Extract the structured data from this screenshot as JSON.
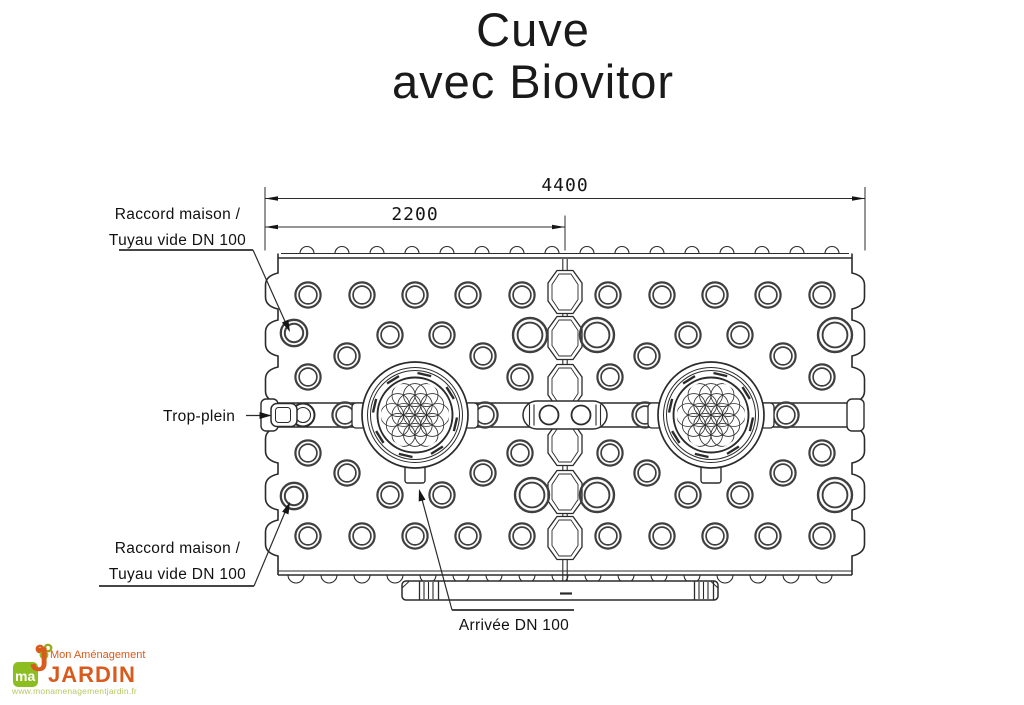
{
  "title": {
    "line1": "Cuve",
    "line2": "avec Biovitor"
  },
  "dimensions": {
    "overall_width_mm": "4400",
    "module_width_mm": "2200"
  },
  "labels": {
    "raccord_top_line1": "Raccord maison /",
    "raccord_top_line2": "Tuyau vide DN 100",
    "trop_plein": "Trop-plein",
    "raccord_bottom_line1": "Raccord maison /",
    "raccord_bottom_line2": "Tuyau vide DN 100",
    "arrivee": "Arrivée DN 100"
  },
  "logo": {
    "brand_top": "Mon Aménagement",
    "brand_main": "JARDIN",
    "url": "www.monamenagementjardin.fr",
    "mark_text": "ma",
    "mark_j": "J",
    "green": "#8cbe22",
    "orange": "#d85a1c",
    "light_green": "#b7c865"
  },
  "drawing": {
    "line_color": "#2b2b2b",
    "ring_color": "#3f3f3f",
    "tank": {
      "left": 278,
      "right": 852,
      "top": 258,
      "bottom": 575,
      "edge_bump_y": [
        291,
        338,
        385,
        445,
        492,
        538
      ],
      "top_scallops": {
        "start": 307,
        "step": 35,
        "end": 845,
        "r": 7
      },
      "bottom_scallops": {
        "start": 296,
        "step": 33,
        "end": 845,
        "r": 8
      }
    },
    "seam_x": 565,
    "seam_hex_y": [
      292,
      338,
      386,
      444,
      492,
      538
    ],
    "band": {
      "y1": 403,
      "y2": 427
    },
    "hole_rows": [
      {
        "y": 295,
        "size": "s",
        "x": [
          308,
          362,
          415,
          468,
          522,
          608,
          662,
          715,
          768,
          822
        ]
      },
      {
        "y": 335,
        "size": "s",
        "x": [
          390,
          442,
          688,
          740
        ]
      },
      {
        "y": 335,
        "size": "l",
        "x": [
          530,
          597,
          835
        ]
      },
      {
        "y": 356,
        "size": "s",
        "x": [
          347,
          483,
          647,
          783
        ]
      },
      {
        "y": 377,
        "size": "s",
        "x": [
          308,
          520,
          610,
          822
        ]
      },
      {
        "y": 415,
        "size": "s",
        "x": [
          345,
          485,
          645,
          786
        ]
      },
      {
        "y": 453,
        "size": "s",
        "x": [
          308,
          520,
          610,
          822
        ]
      },
      {
        "y": 473,
        "size": "s",
        "x": [
          347,
          483,
          647,
          783
        ]
      },
      {
        "y": 495,
        "size": "s",
        "x": [
          390,
          442,
          688,
          740
        ]
      },
      {
        "y": 495,
        "size": "l",
        "x": [
          532,
          597,
          835
        ]
      },
      {
        "y": 536,
        "size": "s",
        "x": [
          308,
          362,
          415,
          468,
          522,
          608,
          662,
          715,
          768,
          822
        ]
      }
    ],
    "raccords": [
      [
        294,
        333
      ],
      [
        294,
        496
      ]
    ],
    "manholes": [
      [
        415,
        415
      ],
      [
        711,
        415
      ]
    ],
    "pipe": {
      "x": 402,
      "y": 581,
      "w": 316,
      "h": 19
    },
    "dims": {
      "x_left": 265,
      "x_mid": 565,
      "x_right": 865,
      "y_overall": 198.5,
      "y_half": 227
    }
  }
}
